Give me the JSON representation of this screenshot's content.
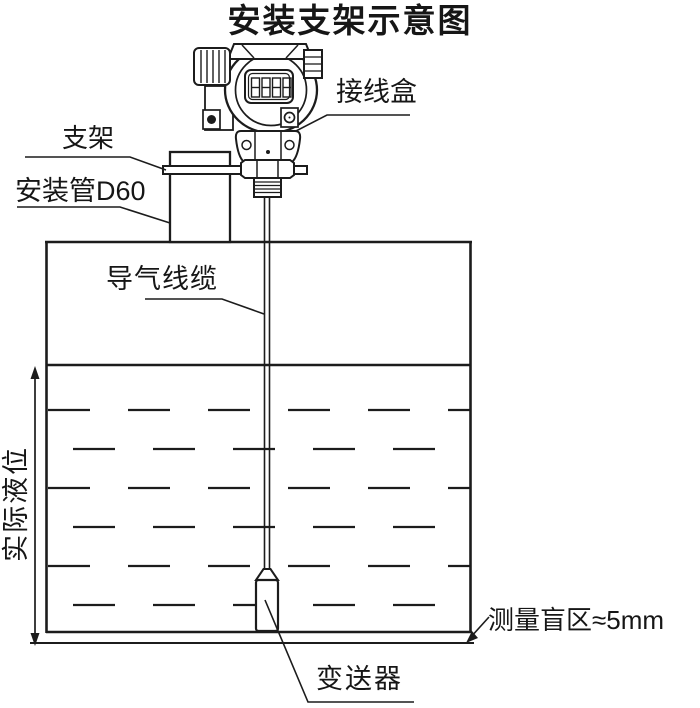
{
  "title": "安装支架示意图",
  "colors": {
    "line": "#1c1c1c",
    "background": "#ffffff"
  },
  "labels": {
    "junction_box": "接线盒",
    "bracket": "支架",
    "mounting_pipe": "安装管D60",
    "air_cable": "导气线缆",
    "actual_level": "实际液位",
    "blind_zone": "测量盲区≈5mm",
    "transmitter": "变送器"
  }
}
